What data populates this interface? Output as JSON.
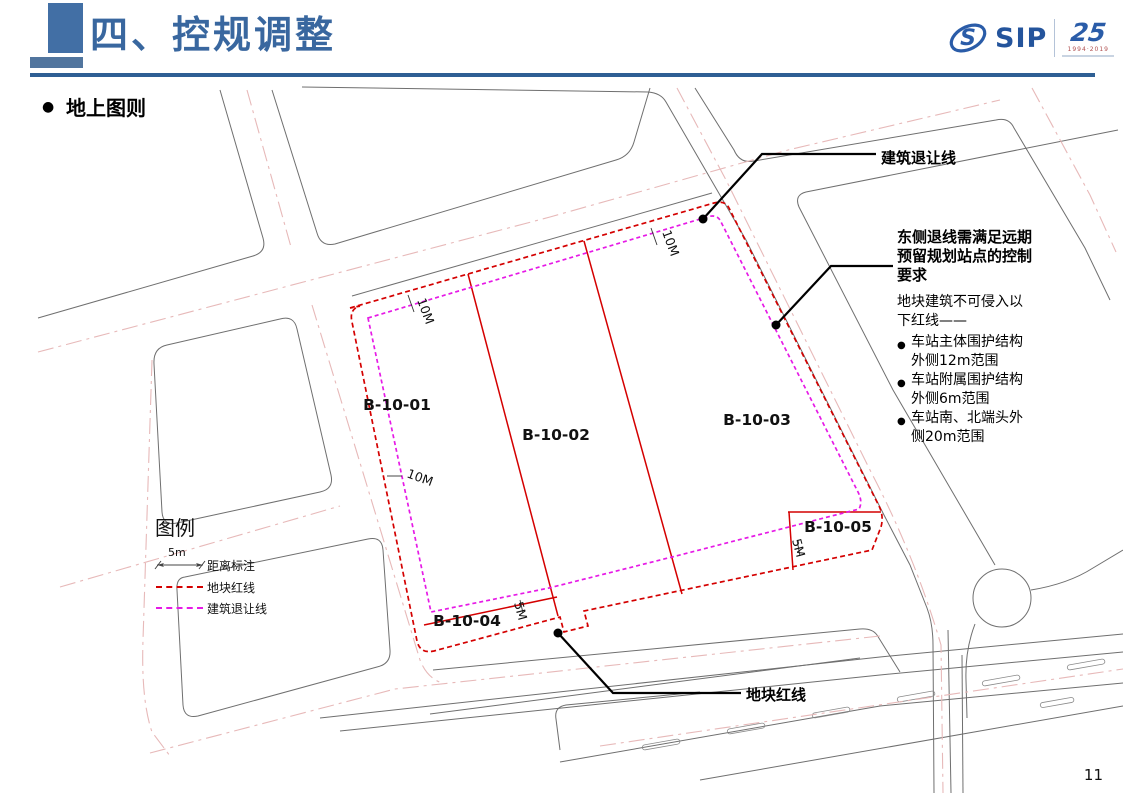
{
  "header": {
    "title": "四、控规调整",
    "section": "地上图则",
    "page": "11"
  },
  "logo": {
    "s": "S",
    "sip": "SIP",
    "anniversary": "25",
    "years": "1994·2019"
  },
  "legend": {
    "title": "图例",
    "dim_value": "5m",
    "items": [
      {
        "label": "距离标注"
      },
      {
        "label": "地块红线"
      },
      {
        "label": "建筑退让线"
      }
    ]
  },
  "map": {
    "parcels": [
      {
        "label": "B-10-01"
      },
      {
        "label": "B-10-02"
      },
      {
        "label": "B-10-03"
      },
      {
        "label": "B-10-04"
      },
      {
        "label": "B-10-05"
      }
    ],
    "dims": [
      {
        "t": "10M"
      },
      {
        "t": "10M"
      },
      {
        "t": "10M"
      },
      {
        "t": "5M"
      },
      {
        "t": "5M"
      }
    ],
    "callouts": {
      "setback_line": "建筑退让线",
      "red_line": "地块红线",
      "east": {
        "title": "东侧退线需满足远期预留规划站点的控制要求",
        "body": "地块建筑不可侵入以下红线——",
        "bullets": [
          "车站主体围护结构外侧12m范围",
          "车站附属围护结构外侧6m范围",
          "车站南、北端头外侧20m范围"
        ]
      }
    },
    "colors": {
      "plot_red": "#d40000",
      "setback_magenta": "#e61ae6",
      "road_gray": "#6f6f6f",
      "centerline_pink": "#e7b9b9",
      "header_blue": "#39679f"
    }
  }
}
